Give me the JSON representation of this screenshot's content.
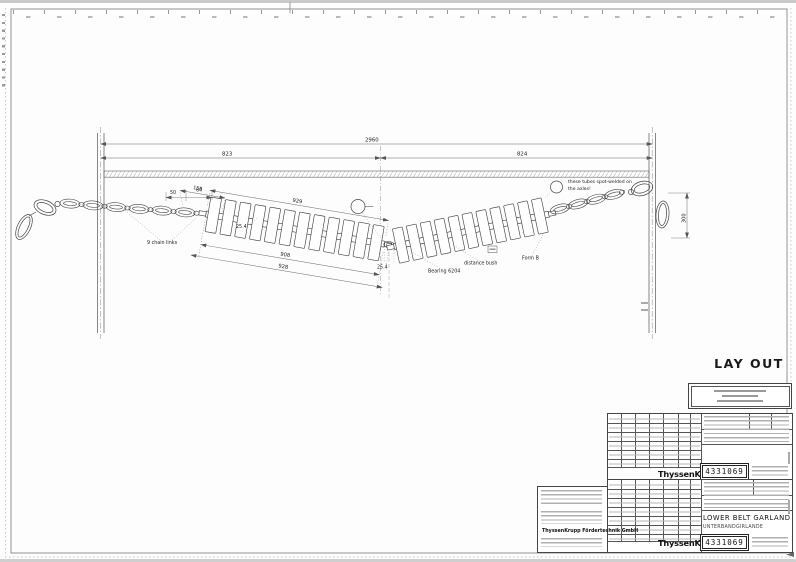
{
  "frame": {
    "layout_label": "LAY OUT"
  },
  "drawing": {
    "dim_overall": "2960",
    "dim_left_span": "823",
    "dim_right_span": "824",
    "dim_roller_top_short": "150",
    "dim_roller_top_long": "929",
    "dim_roller_bottom_a": "908",
    "dim_roller_bottom_b": "928",
    "dim_chain_short_a": "50",
    "dim_chain_short_b": "64",
    "dim_gap_left": "25.4",
    "dim_gap_center": "25.4",
    "dim_ring_height": "300",
    "label_chain_links": "9 chain links",
    "label_bearing": "Bearing 6204",
    "label_distance_bush": "distance bush",
    "label_form": "Form B",
    "note_weld_1": "these tubes spot-welded on",
    "note_weld_2": "the axles!"
  },
  "title_block": {
    "brand": "ThyssenKrupp",
    "drawing_number": "4331069",
    "title_en": "LOWER BELT GARLAND",
    "title_de": "UNTERBANDGIRLANDE",
    "company": "ThyssenKrupp Fördertechnik GmbH"
  }
}
